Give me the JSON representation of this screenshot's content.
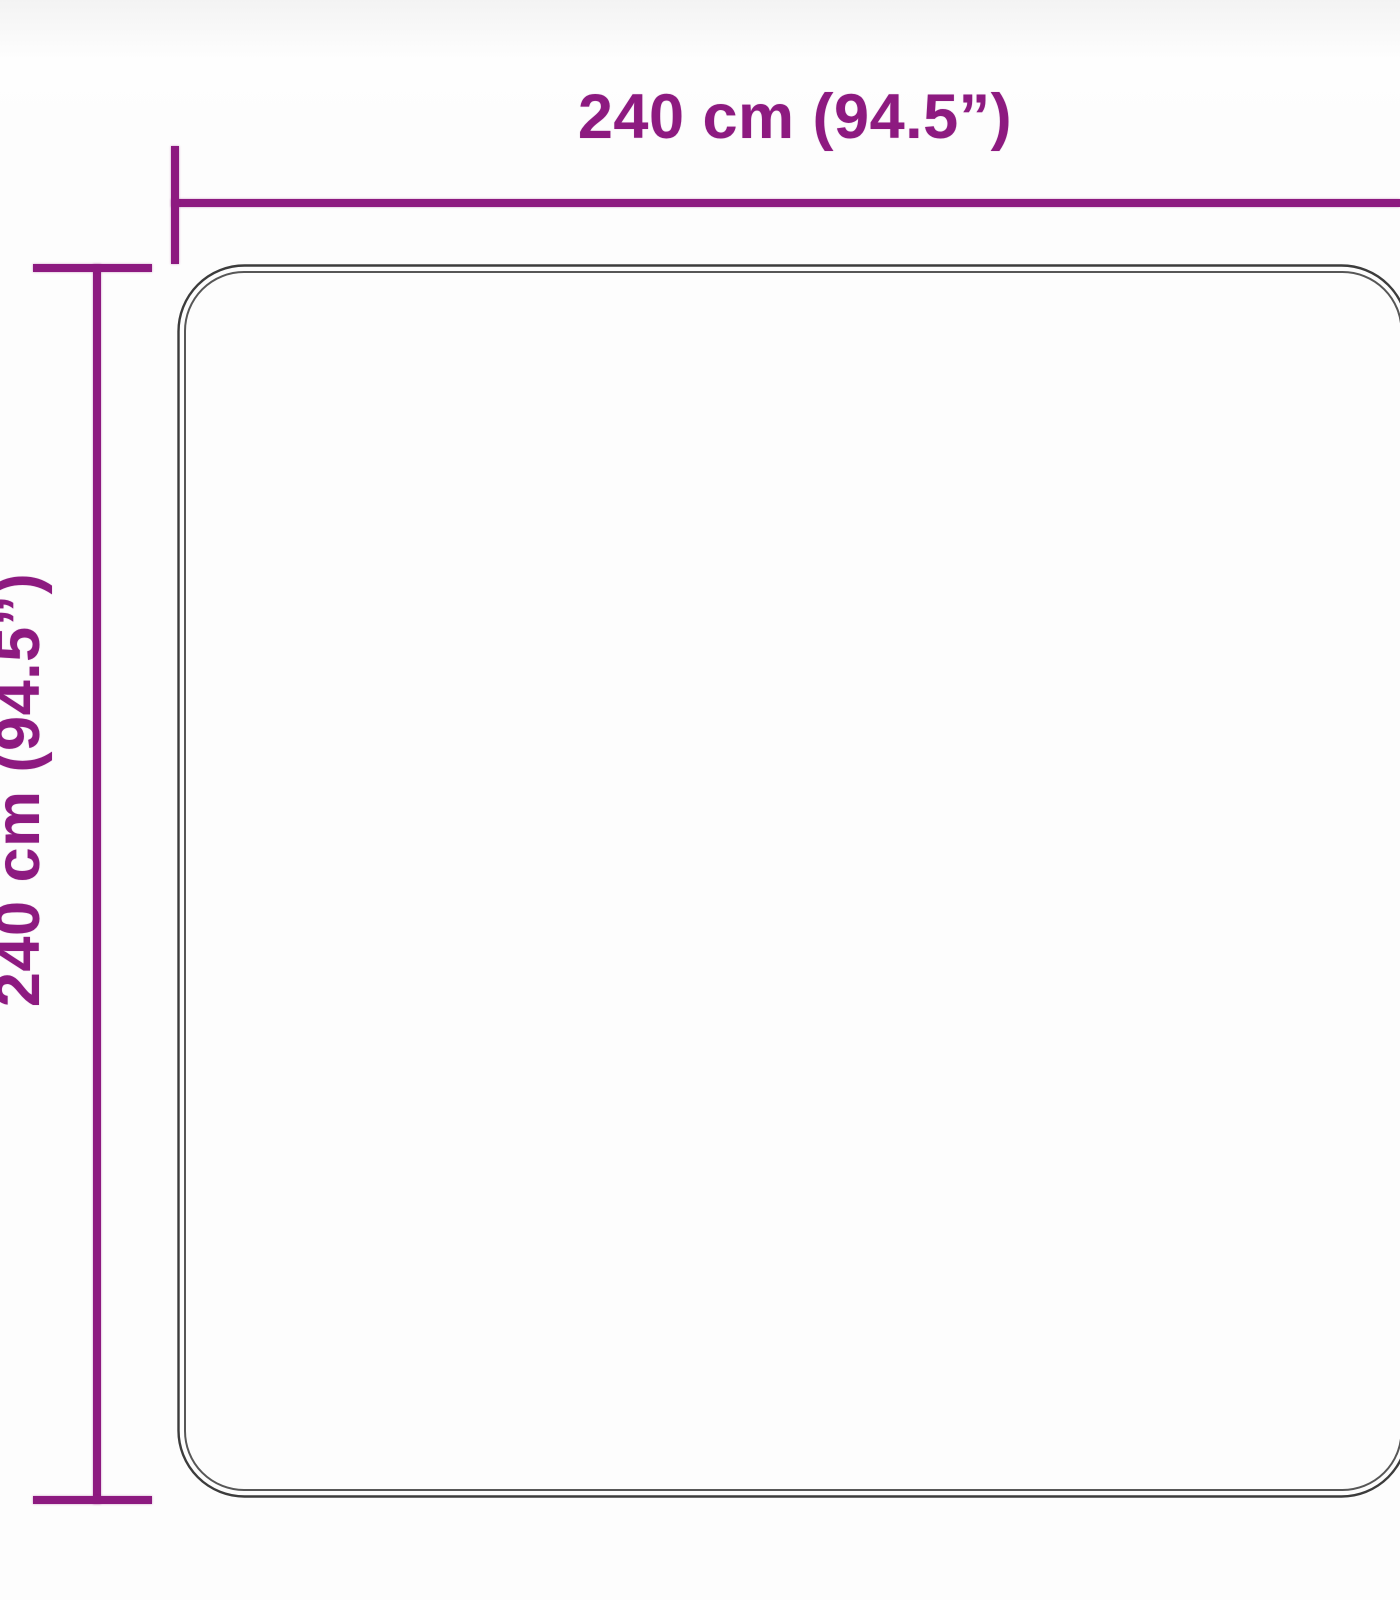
{
  "diagram": {
    "width_label": "240 cm (94.5”)",
    "height_label": "240 cm (94.5”)",
    "width_cm": 240,
    "height_cm": 240,
    "width_inches": 94.5,
    "height_inches": 94.5,
    "colors": {
      "dimension": "#8d1a80",
      "outline": "#3c3c3c",
      "outline_inner": "#575757",
      "background": "#fdfdfd"
    }
  }
}
